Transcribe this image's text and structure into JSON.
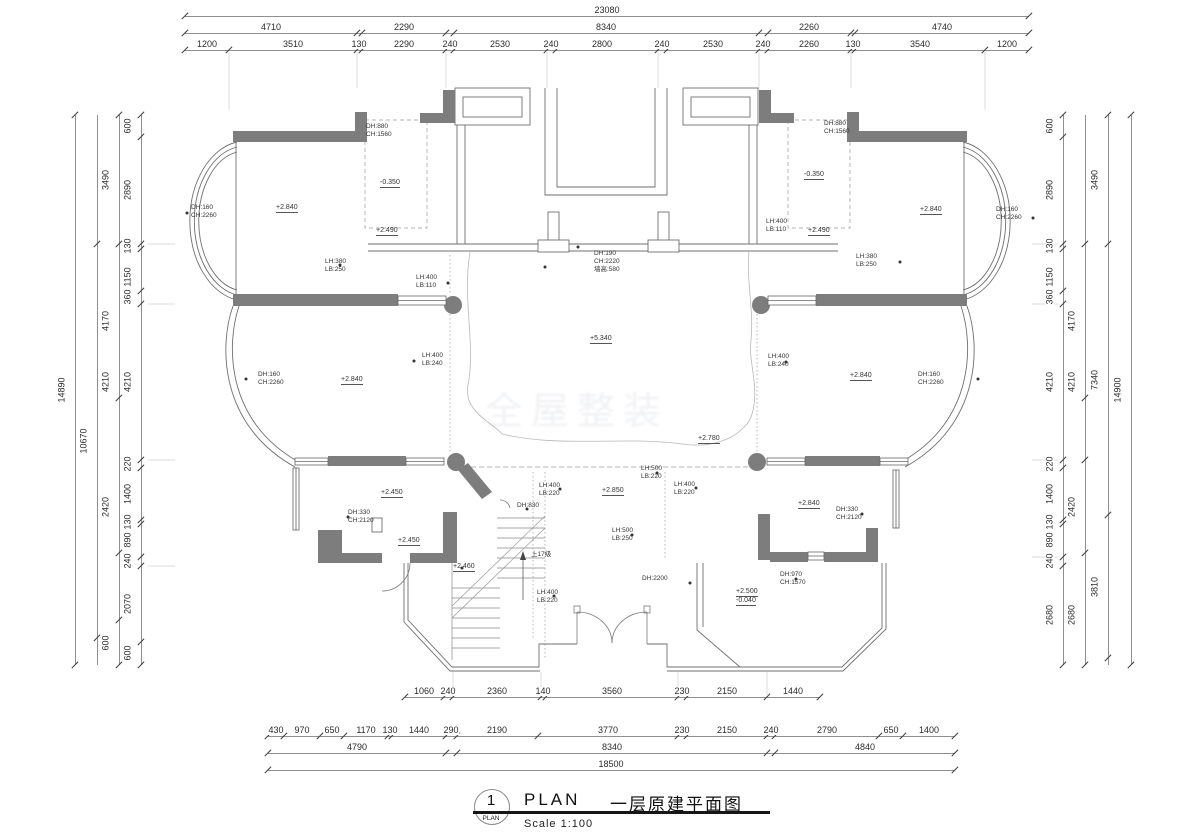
{
  "title_block": {
    "number": "1",
    "circle_caption": "PLAN",
    "plan_text": "PLAN",
    "drawing_name": "一层原建平面图",
    "scale_text": "Scale 1:100"
  },
  "watermark": {
    "text": "全屋整装"
  },
  "stair_note": "上17级",
  "colors": {
    "wall_fill": "#7d7d7d",
    "line": "#6f6f6f",
    "dim_text": "#2b2b2b"
  },
  "dims": {
    "h_rows": [
      {
        "y": 16,
        "x0": 185,
        "x1": 1029,
        "ticks": [
          185,
          1029
        ],
        "labels": [
          {
            "t": "23080",
            "x": 607
          }
        ]
      },
      {
        "y": 33,
        "x0": 185,
        "x1": 1029,
        "ticks": [
          185,
          357,
          362,
          446,
          454,
          759,
          768,
          851,
          855,
          1029
        ],
        "labels": [
          {
            "t": "4710",
            "x": 271
          },
          {
            "t": "2290",
            "x": 404
          },
          {
            "t": "8340",
            "x": 606
          },
          {
            "t": "2260",
            "x": 809
          },
          {
            "t": "4740",
            "x": 942
          }
        ]
      },
      {
        "y": 50,
        "x0": 185,
        "x1": 1029,
        "ticks": [
          185,
          229,
          357,
          362,
          446,
          454,
          547,
          556,
          658,
          667,
          759,
          768,
          851,
          855,
          985,
          1029
        ],
        "labels": [
          {
            "t": "1200",
            "x": 207
          },
          {
            "t": "3510",
            "x": 293
          },
          {
            "t": "130",
            "x": 359
          },
          {
            "t": "2290",
            "x": 404
          },
          {
            "t": "240",
            "x": 450
          },
          {
            "t": "2530",
            "x": 500
          },
          {
            "t": "240",
            "x": 551
          },
          {
            "t": "2800",
            "x": 602
          },
          {
            "t": "240",
            "x": 662
          },
          {
            "t": "2530",
            "x": 713
          },
          {
            "t": "240",
            "x": 763
          },
          {
            "t": "2260",
            "x": 809
          },
          {
            "t": "130",
            "x": 853
          },
          {
            "t": "3540",
            "x": 920
          },
          {
            "t": "1200",
            "x": 1007
          }
        ]
      },
      {
        "y": 697,
        "x0": 405,
        "x1": 820,
        "ticks": [
          405,
          444,
          453,
          541,
          546,
          678,
          687,
          767,
          820
        ],
        "labels": [
          {
            "t": "1060",
            "x": 424
          },
          {
            "t": "240",
            "x": 448
          },
          {
            "t": "2360",
            "x": 497
          },
          {
            "t": "140",
            "x": 543
          },
          {
            "t": "3560",
            "x": 612
          },
          {
            "t": "230",
            "x": 682
          },
          {
            "t": "2150",
            "x": 727
          },
          {
            "t": "1440",
            "x": 793
          }
        ]
      },
      {
        "y": 736,
        "x0": 268,
        "x1": 955,
        "ticks": [
          268,
          284,
          320,
          344,
          388,
          392,
          446,
          457,
          538,
          678,
          687,
          767,
          775,
          879,
          903,
          955
        ],
        "labels": [
          {
            "t": "430",
            "x": 276
          },
          {
            "t": "970",
            "x": 302
          },
          {
            "t": "650",
            "x": 332
          },
          {
            "t": "1170",
            "x": 366
          },
          {
            "t": "130",
            "x": 390
          },
          {
            "t": "1440",
            "x": 419
          },
          {
            "t": "290",
            "x": 451
          },
          {
            "t": "2190",
            "x": 497
          },
          {
            "t": "3770",
            "x": 608
          },
          {
            "t": "230",
            "x": 682
          },
          {
            "t": "2150",
            "x": 727
          },
          {
            "t": "240",
            "x": 771
          },
          {
            "t": "2790",
            "x": 827
          },
          {
            "t": "650",
            "x": 891
          },
          {
            "t": "1400",
            "x": 929
          }
        ]
      },
      {
        "y": 753,
        "x0": 268,
        "x1": 955,
        "ticks": [
          268,
          446,
          457,
          767,
          775,
          955
        ],
        "labels": [
          {
            "t": "4790",
            "x": 357
          },
          {
            "t": "8340",
            "x": 612
          },
          {
            "t": "4840",
            "x": 865
          }
        ]
      },
      {
        "y": 770,
        "x0": 268,
        "x1": 955,
        "ticks": [
          268,
          955
        ],
        "labels": [
          {
            "t": "18500",
            "x": 611
          }
        ]
      }
    ],
    "v_cols": [
      {
        "x": 75,
        "y0": 115,
        "y1": 665,
        "ticks": [
          115,
          665
        ],
        "labels": [
          {
            "t": "14890",
            "y": 390
          }
        ]
      },
      {
        "x": 97,
        "y0": 115,
        "y1": 665,
        "ticks": [
          244,
          638
        ],
        "labels": [
          {
            "t": "10670",
            "y": 441
          }
        ]
      },
      {
        "x": 119,
        "y0": 115,
        "y1": 665,
        "ticks": [
          115,
          244,
          398,
          553,
          620,
          665
        ],
        "labels": [
          {
            "t": "3490",
            "y": 180
          },
          {
            "t": "4170",
            "y": 321
          },
          {
            "t": "4210",
            "y": 382
          },
          {
            "t": "2420",
            "y": 507
          },
          {
            "t": "600",
            "y": 643
          }
        ]
      },
      {
        "x": 141,
        "y0": 115,
        "y1": 665,
        "ticks": [
          115,
          137,
          244,
          249,
          291,
          304,
          460,
          468,
          520,
          524,
          557,
          566,
          642,
          665
        ],
        "labels": [
          {
            "t": "600",
            "y": 126
          },
          {
            "t": "2890",
            "y": 190
          },
          {
            "t": "130",
            "y": 246
          },
          {
            "t": "1150",
            "y": 277
          },
          {
            "t": "360",
            "y": 297
          },
          {
            "t": "4210",
            "y": 382
          },
          {
            "t": "220",
            "y": 464
          },
          {
            "t": "1400",
            "y": 494
          },
          {
            "t": "130",
            "y": 522
          },
          {
            "t": "890",
            "y": 540
          },
          {
            "t": "240",
            "y": 561
          },
          {
            "t": "2070",
            "y": 604
          },
          {
            "t": "600",
            "y": 653
          }
        ]
      },
      {
        "x": 1063,
        "y0": 115,
        "y1": 665,
        "ticks": [
          115,
          137,
          244,
          249,
          291,
          304,
          460,
          468,
          520,
          524,
          557,
          566,
          665
        ],
        "labels": [
          {
            "t": "600",
            "y": 126
          },
          {
            "t": "2890",
            "y": 190
          },
          {
            "t": "130",
            "y": 246
          },
          {
            "t": "1150",
            "y": 277
          },
          {
            "t": "360",
            "y": 297
          },
          {
            "t": "4210",
            "y": 382
          },
          {
            "t": "220",
            "y": 464
          },
          {
            "t": "1400",
            "y": 494
          },
          {
            "t": "130",
            "y": 522
          },
          {
            "t": "890",
            "y": 540
          },
          {
            "t": "240",
            "y": 561
          },
          {
            "t": "2680",
            "y": 615
          }
        ]
      },
      {
        "x": 1085,
        "y0": 115,
        "y1": 665,
        "ticks": [
          244,
          398,
          460,
          553,
          665
        ],
        "labels": [
          {
            "t": "4170",
            "y": 321
          },
          {
            "t": "4210",
            "y": 382
          },
          {
            "t": "2420",
            "y": 507
          },
          {
            "t": "2680",
            "y": 615
          }
        ]
      },
      {
        "x": 1108,
        "y0": 115,
        "y1": 665,
        "ticks": [
          115,
          244,
          515,
          658
        ],
        "labels": [
          {
            "t": "3490",
            "y": 180
          },
          {
            "t": "7340",
            "y": 380
          },
          {
            "t": "3810",
            "y": 587
          }
        ]
      },
      {
        "x": 1131,
        "y0": 115,
        "y1": 665,
        "ticks": [
          115,
          665
        ],
        "labels": [
          {
            "t": "14900",
            "y": 390
          }
        ]
      }
    ]
  },
  "annotations": [
    {
      "t": "DH:160",
      "x": 191,
      "y": 205
    },
    {
      "t": "CH:2260",
      "x": 191,
      "y": 213
    },
    {
      "t": "+2.840",
      "x": 276,
      "y": 204,
      "u": true
    },
    {
      "t": "DH:880",
      "x": 366,
      "y": 124
    },
    {
      "t": "CH:1560",
      "x": 366,
      "y": 132
    },
    {
      "t": "-0.350",
      "x": 380,
      "y": 179,
      "u": true
    },
    {
      "t": "+2.490",
      "x": 376,
      "y": 227,
      "u": true
    },
    {
      "t": "LH:380",
      "x": 325,
      "y": 259
    },
    {
      "t": "LB:250",
      "x": 325,
      "y": 267
    },
    {
      "t": "LH:400",
      "x": 416,
      "y": 275
    },
    {
      "t": "LB:110",
      "x": 416,
      "y": 283
    },
    {
      "t": "DH:190",
      "x": 594,
      "y": 251
    },
    {
      "t": "CH:2220",
      "x": 594,
      "y": 259
    },
    {
      "t": "墙高:580",
      "x": 594,
      "y": 267
    },
    {
      "t": "+5.340",
      "x": 590,
      "y": 335,
      "u": true
    },
    {
      "t": "DH:160",
      "x": 258,
      "y": 372
    },
    {
      "t": "CH:2260",
      "x": 258,
      "y": 380
    },
    {
      "t": "+2.840",
      "x": 341,
      "y": 376,
      "u": true
    },
    {
      "t": "LH:400",
      "x": 422,
      "y": 353
    },
    {
      "t": "LB:240",
      "x": 422,
      "y": 361
    },
    {
      "t": "LH:400",
      "x": 768,
      "y": 354
    },
    {
      "t": "LB:240",
      "x": 768,
      "y": 362
    },
    {
      "t": "+2.840",
      "x": 850,
      "y": 372,
      "u": true
    },
    {
      "t": "DH:160",
      "x": 918,
      "y": 372
    },
    {
      "t": "CH:2260",
      "x": 918,
      "y": 380
    },
    {
      "t": "+2.840",
      "x": 920,
      "y": 206,
      "u": true
    },
    {
      "t": "DH:160",
      "x": 996,
      "y": 207
    },
    {
      "t": "CH:2260",
      "x": 996,
      "y": 215
    },
    {
      "t": "DH:880",
      "x": 824,
      "y": 121
    },
    {
      "t": "CH:1560",
      "x": 824,
      "y": 129
    },
    {
      "t": "-0.350",
      "x": 804,
      "y": 171,
      "u": true
    },
    {
      "t": "+2.490",
      "x": 808,
      "y": 227,
      "u": true
    },
    {
      "t": "LH:400",
      "x": 766,
      "y": 219
    },
    {
      "t": "LB:110",
      "x": 766,
      "y": 227
    },
    {
      "t": "LH:380",
      "x": 856,
      "y": 254
    },
    {
      "t": "LB:250",
      "x": 856,
      "y": 262
    },
    {
      "t": "+2.780",
      "x": 698,
      "y": 435,
      "u": true
    },
    {
      "t": "+2.450",
      "x": 381,
      "y": 489,
      "u": true
    },
    {
      "t": "DH:330",
      "x": 348,
      "y": 510
    },
    {
      "t": "CH:2120",
      "x": 348,
      "y": 518
    },
    {
      "t": "+2.450",
      "x": 398,
      "y": 537,
      "u": true
    },
    {
      "t": "DH:830",
      "x": 517,
      "y": 503
    },
    {
      "t": "LH:400",
      "x": 539,
      "y": 483
    },
    {
      "t": "LB:220",
      "x": 539,
      "y": 491
    },
    {
      "t": "+2.850",
      "x": 602,
      "y": 487,
      "u": true
    },
    {
      "t": "LH:500",
      "x": 641,
      "y": 466
    },
    {
      "t": "LB:220",
      "x": 641,
      "y": 474
    },
    {
      "t": "LH:400",
      "x": 674,
      "y": 482
    },
    {
      "t": "LB:220",
      "x": 674,
      "y": 490
    },
    {
      "t": "LH:500",
      "x": 612,
      "y": 528
    },
    {
      "t": "LB:250",
      "x": 612,
      "y": 536
    },
    {
      "t": "上17级",
      "x": 531,
      "y": 552
    },
    {
      "t": "+2.460",
      "x": 453,
      "y": 563,
      "u": true
    },
    {
      "t": "LH:400",
      "x": 537,
      "y": 590
    },
    {
      "t": "LB:220",
      "x": 537,
      "y": 598
    },
    {
      "t": "DH:2200",
      "x": 642,
      "y": 576
    },
    {
      "t": "+2.500",
      "x": 736,
      "y": 588,
      "u": true
    },
    {
      "t": "-0.040",
      "x": 736,
      "y": 597,
      "u": true
    },
    {
      "t": "DH:970",
      "x": 780,
      "y": 572
    },
    {
      "t": "CH:1570",
      "x": 780,
      "y": 580
    },
    {
      "t": "+2.840",
      "x": 798,
      "y": 500,
      "u": true
    },
    {
      "t": "DH:330",
      "x": 836,
      "y": 507
    },
    {
      "t": "CH:2120",
      "x": 836,
      "y": 515
    }
  ],
  "leader_dots": [
    [
      187,
      213
    ],
    [
      1033,
      218
    ],
    [
      578,
      247
    ],
    [
      545,
      267
    ],
    [
      448,
      283
    ],
    [
      414,
      361
    ],
    [
      786,
      362
    ],
    [
      348,
      517
    ],
    [
      527,
      509
    ],
    [
      560,
      489
    ],
    [
      657,
      473
    ],
    [
      696,
      488
    ],
    [
      632,
      535
    ],
    [
      554,
      596
    ],
    [
      690,
      583
    ],
    [
      796,
      579
    ],
    [
      862,
      514
    ],
    [
      246,
      379
    ],
    [
      978,
      379
    ],
    [
      340,
      265
    ],
    [
      900,
      262
    ],
    [
      462,
      568
    ]
  ]
}
